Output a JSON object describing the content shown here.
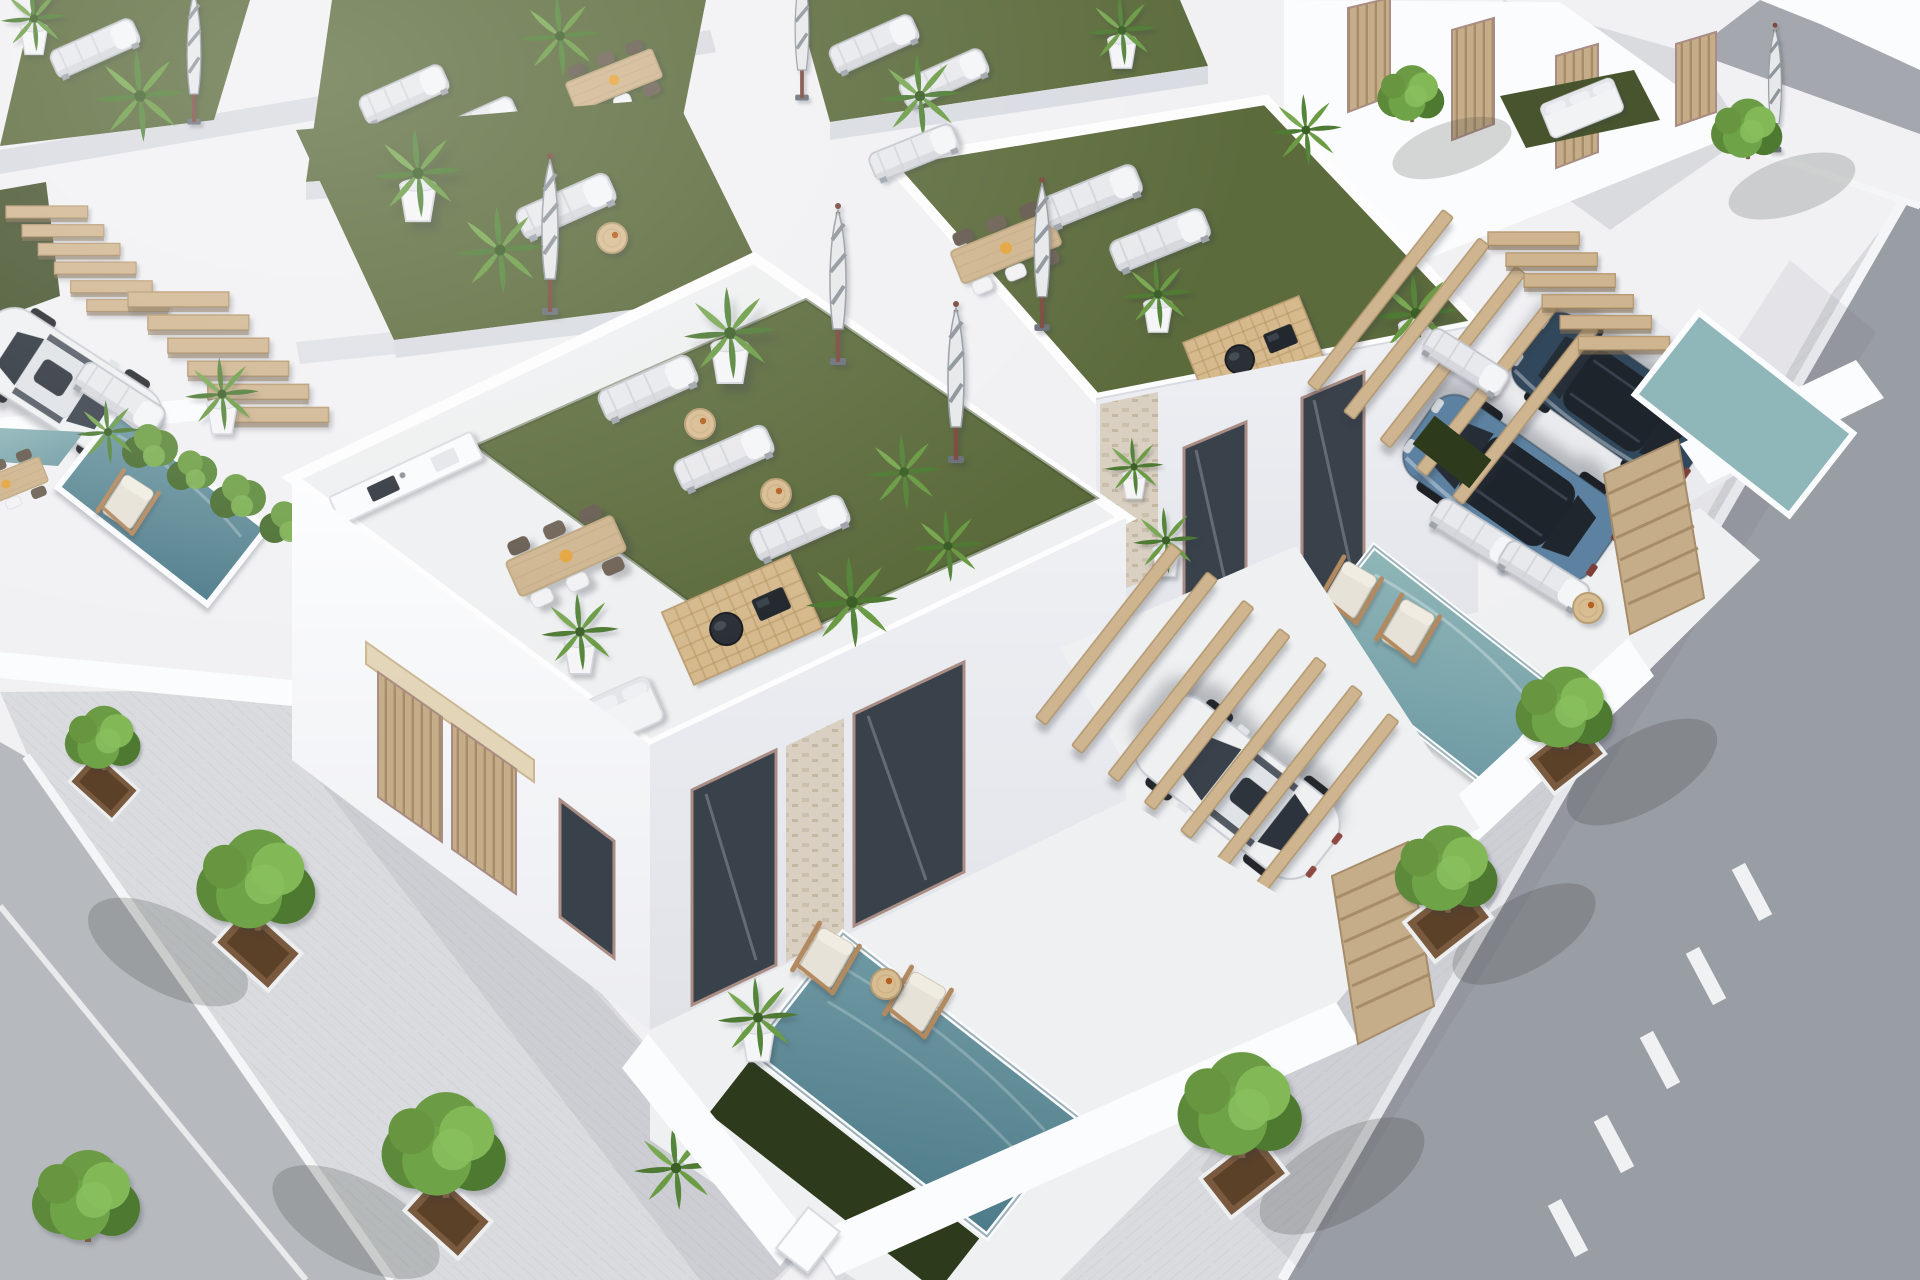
{
  "meta": {
    "type": "3d-architectural-aerial-render",
    "description": "Sunny aerial three-quarter view of a modern all-white residential development: rows of flat-roofed villas with artificial-turf roof terraces furnished with sun loungers, closed striped parasols, potted palms, timber dining sets, barbecue lattice decks and an outdoor kitchen; ground-level patios with teal plunge pools, timber pergolas, stairs and slatted gates; a white sedan, a second white car and two blue SUVs parked in driveways; paver sidewalks with square-pit street trees framing a light asphalt street on the left and a darker asphalt street with a dashed white centre line on the right.",
    "canvas": {
      "width": 1920,
      "height": 1280
    }
  },
  "palette": {
    "wall_bright": "#fbfcfd",
    "wall_base": "#f1f1f4",
    "wall_shade": "#d8dbe1",
    "wall_dark": "#c3c7cf",
    "paving": "#eef0f1",
    "turf": "#5c6b3c",
    "turf_dark": "#47542e",
    "turf_deep": "#2d3a1c",
    "pool_light": "#8fb6b8",
    "pool_mid": "#6f9aa4",
    "pool_deep": "#4e7b89",
    "wood": "#cfb58f",
    "wood_dark": "#b2976f",
    "wood_pale": "#e3d5b8",
    "asphalt_right": "#999da4",
    "asphalt_left": "#b6b9be",
    "sidewalk": "#d9dbde",
    "curb": "#f4f5f7",
    "tree_mid": "#5d8a3a",
    "tree_dark": "#4d7a30",
    "tree_light": "#83b857",
    "trunk": "#7a5f46",
    "pit": "#7a5a3e",
    "pit_dark": "#5c4129",
    "car_white": "#eef0f2",
    "suv_steel_blue": "#5d81a1",
    "suv_dark_blue": "#31485c",
    "glass": "#39414b",
    "stone": "#d9d0c2",
    "frame": "#a98d84",
    "grill": "#2b3036",
    "parasol_canvas": "#e6e8ea",
    "parasol_stripe": "#8f959c"
  },
  "scene": {
    "streets": {
      "left": {
        "surface": "light asphalt",
        "markings": [
          "white painted edge line"
        ],
        "sidewalk_trees": 4
      },
      "right": {
        "surface": "dark asphalt",
        "markings": [
          "dashed white centre line"
        ],
        "sidewalk_trees": 3
      },
      "tree_planters": "square brown pits in paver sidewalk"
    },
    "corner_villa": {
      "roof_terrace": {
        "surface": "artificial turf",
        "sun_loungers": 3,
        "closed_parasols": 2,
        "dining_seats": 6,
        "barbecue_lattice_deck": true,
        "outdoor_kitchen_sink": true,
        "potted_palms": 3,
        "white_sofa": true,
        "side_tables": 2
      },
      "ground": {
        "plunge_pool": "slate teal",
        "dark_turf_strip": true,
        "timber_deck_chairs": 2,
        "side_table": 1,
        "pergola_beams": 7,
        "slatted_gates": 2,
        "stone_clad_pillar": true,
        "parked_vehicle": "white sedan",
        "driveway_grass_strips": 2
      }
    },
    "right_villa": {
      "roof_terrace": {
        "surface": "artificial turf",
        "sun_loungers": 3,
        "dining_seats": 6,
        "closed_parasols": 1,
        "barbecue_lattice_deck": true,
        "potted_palms": 3
      },
      "ground": {
        "plunge_pool": "teal",
        "sun_loungers": 2,
        "timber_deck_chairs": 2,
        "timber_stairs": true,
        "pergola_beams": 5,
        "louvre_fences": 2,
        "parked_vehicles": [
          "steel blue SUV",
          "dark blue SUV"
        ]
      }
    },
    "background": {
      "roof_gardens": 6,
      "closed_parasols": 4,
      "dining_sets": 2,
      "sun_loungers": 7,
      "far_right_plunge_pool": true,
      "corner_lawn_with_white_sofa": true,
      "timber_entrance_doors": 4,
      "small_trees": 2
    },
    "left_neighbours": {
      "plunge_pools": 2,
      "stair_flights": 2,
      "white_car_partially_visible": true,
      "planter_shrubs": 5,
      "sun_lounger": 1,
      "deck_chair": 1,
      "dining_set_partial": true
    }
  }
}
